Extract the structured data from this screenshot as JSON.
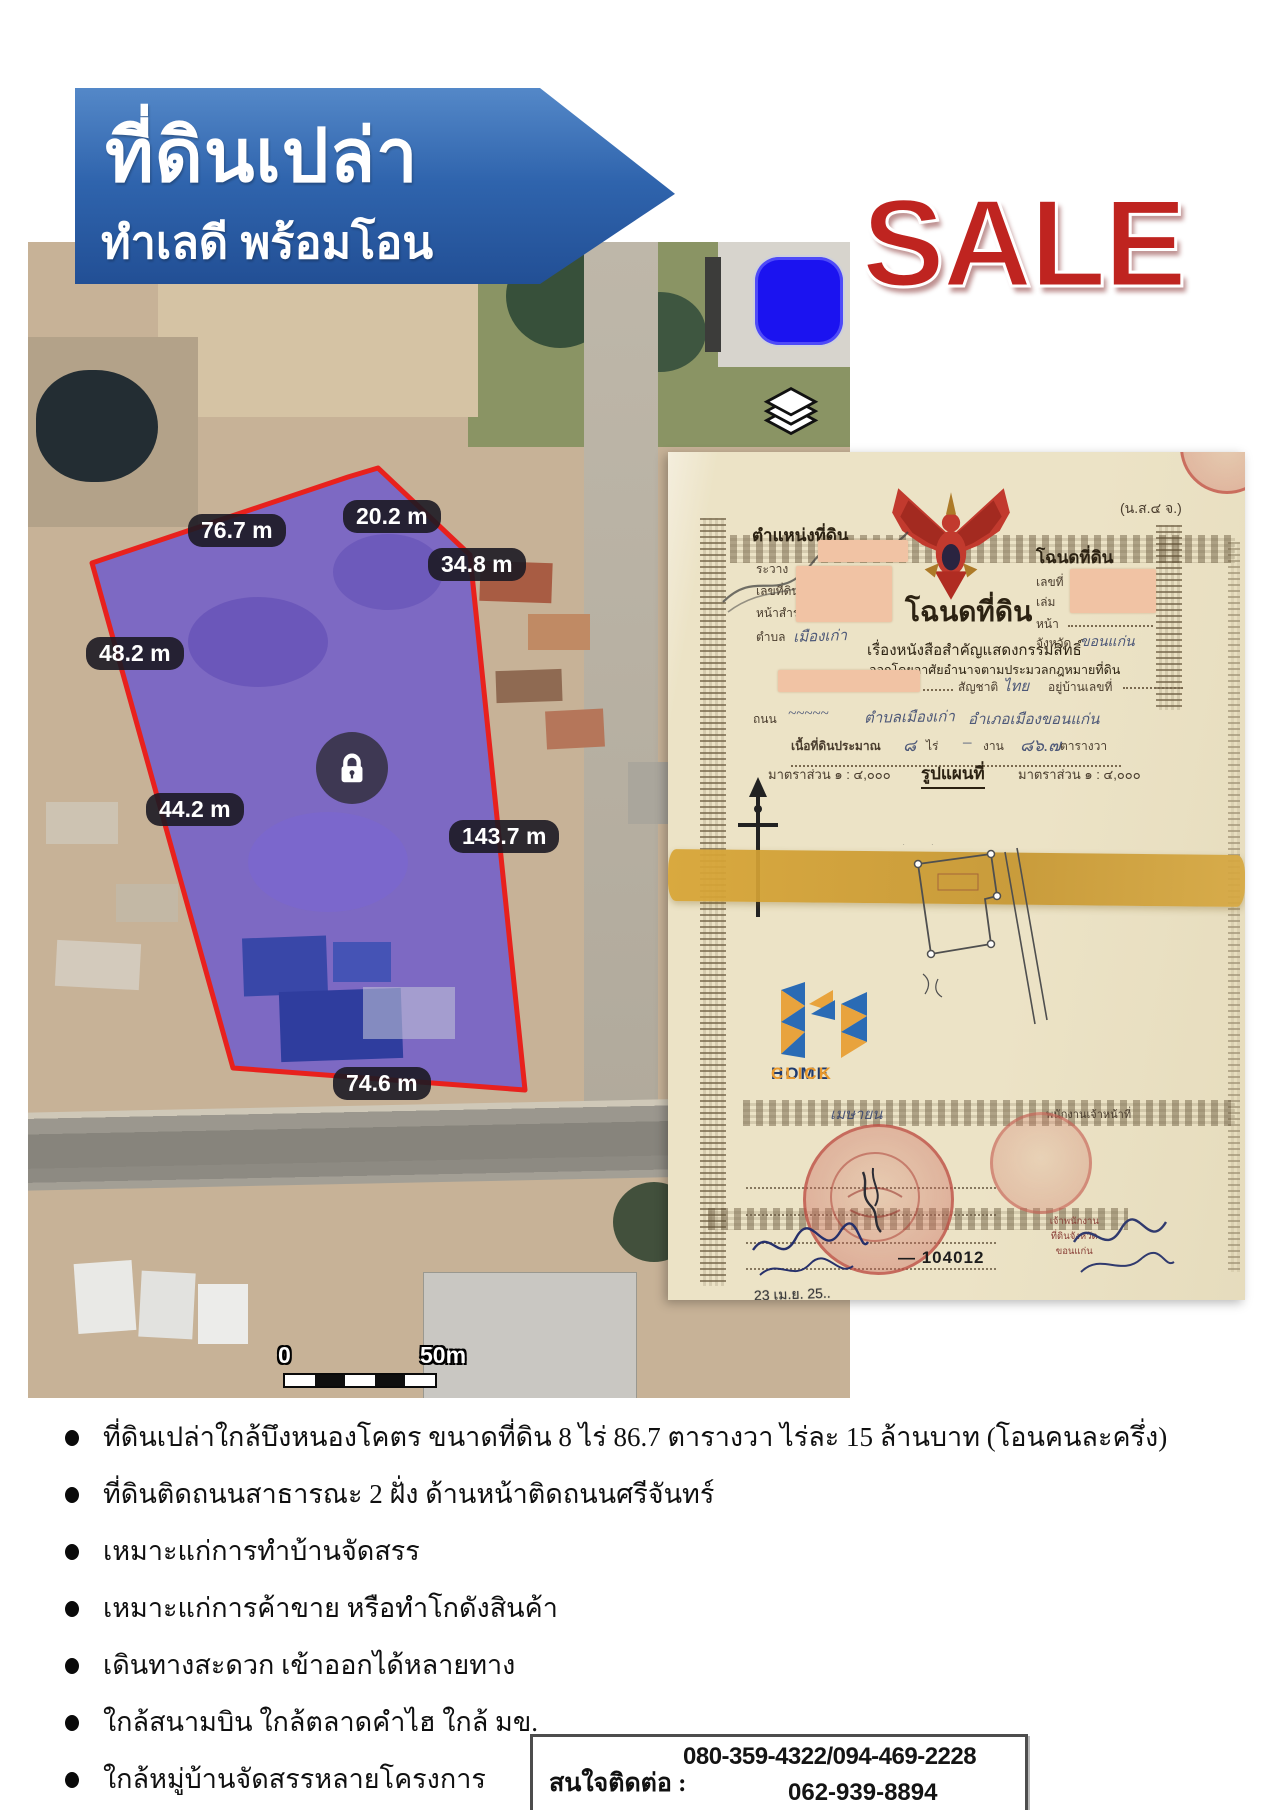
{
  "banner": {
    "title": "ที่ดินเปล่า",
    "subtitle": "ทำเลดี พร้อมโอน",
    "color": "#2f64ad"
  },
  "sale_label": "SALE",
  "colors": {
    "sale_red": "#bf2420",
    "marker_blue": "#1b13f0",
    "plot_fill": "#614cd4",
    "plot_border": "#e8211d",
    "logo_navy": "#1e3a6e",
    "logo_orange": "#e8992e"
  },
  "map": {
    "icons": [
      "lock-icon",
      "layers-icon",
      "blue-marker-square"
    ],
    "measurements": [
      "76.7 m",
      "20.2 m",
      "34.8 m",
      "48.2 m",
      "44.2 m",
      "143.7 m",
      "74.6 m"
    ],
    "scale_bar": {
      "start": "0",
      "end": "50m"
    }
  },
  "deed": {
    "corner_label": "(น.ส.๔ จ.)",
    "left_block": {
      "title": "ตำแหน่งที่ดิน",
      "field_ravang": "ระวาง",
      "field_land_no": "เลขที่ดิน",
      "field_survey": "หน้าสำรวจ",
      "field_tambon": "ตำบล",
      "tambon_value": "เมืองเก่า"
    },
    "right_block": {
      "title": "โฉนดที่ดิน",
      "field_no": "เลขที่",
      "field_book": "เล่ม",
      "field_page": "หน้า",
      "field_province": "จังหวัด",
      "province_value": "ขอนแก่น"
    },
    "title": "โฉนดที่ดิน",
    "subtitle1": "เรื่องหนังสือสำคัญแสดงกรรมสิทธิ์",
    "subtitle2": "ออกโดยอาศัยอำนาจตามประมวลกฎหมายที่ดิน",
    "row_nationality_label": "สัญชาติ",
    "row_nationality_value": "ไทย",
    "row_address_label": "อยู่บ้านเลขที่",
    "row_road_label": "ถนน",
    "row_tambon": "ตำบลเมืองเก่า",
    "row_amphoe": "อำเภอเมืองขอนแก่น",
    "area_label": "เนื้อที่ดินประมาณ",
    "area_rai": "๘",
    "rai_label": "ไร่",
    "area_ngan": "–",
    "ngan_label": "งาน",
    "area_wa": "๘๖.๗",
    "wa_label": "ตารางวา",
    "scale_left": "มาตราส่วน ๑ : ๔,๐๐๐",
    "plan_label": "รูปแผนที่",
    "scale_right": "มาตราส่วน ๑ : ๔,๐๐๐",
    "month_hand": "เมษายน",
    "officer_label": "พนักงานเจ้าหน้าที่",
    "stamp_caption": "เจ้าพนักงานที่ดินจังหวัดขอนแก่น",
    "doc_number": "— 104012",
    "date_stamp": "23 เม.ย. 25..",
    "logo": {
      "home": "HOME",
      "click": "CLICK"
    }
  },
  "bullets": [
    "ที่ดินเปล่าใกล้บึงหนองโคตร ขนาดที่ดิน  8 ไร่ 86.7 ตารางวา ไร่ละ 15 ล้านบาท (โอนคนละครึ่ง)",
    "ที่ดินติดถนนสาธารณะ 2 ฝั่ง ด้านหน้าติดถนนศรีจันทร์",
    "เหมาะแก่การทำบ้านจัดสรร",
    "เหมาะแก่การค้าขาย หรือทำโกดังสินค้า",
    "เดินทางสะดวก เข้าออกได้หลายทาง",
    "ใกล้สนามบิน ใกล้ตลาดคำไฮ ใกล้ มข.",
    "ใกล้หมู่บ้านจัดสรรหลายโครงการ"
  ],
  "contact": {
    "label": "สนใจติดต่อ :",
    "phone_line1": "080-359-4322/094-469-2228",
    "phone_line2": "062-939-8894"
  }
}
